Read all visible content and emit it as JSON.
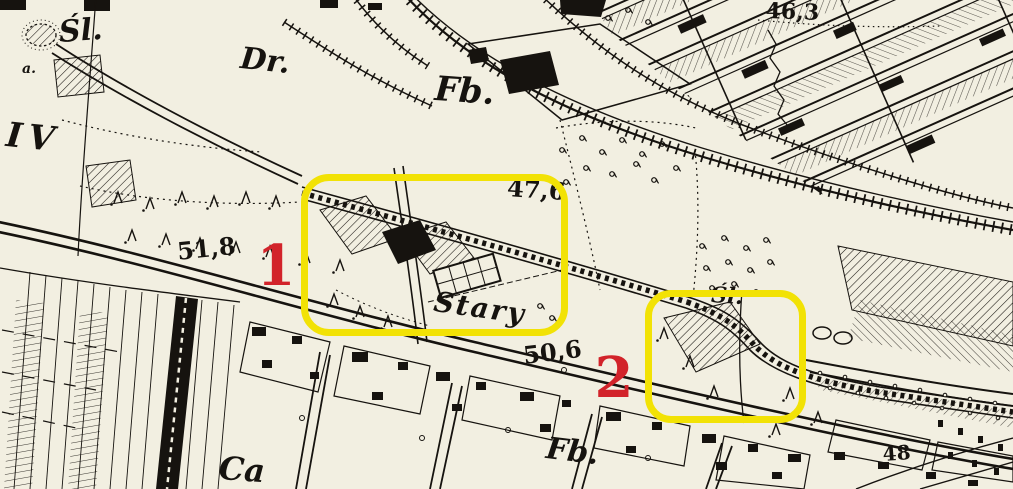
{
  "map": {
    "description": "Historical black-and-white topographic map scan with two yellow highlight boxes numbered in red",
    "colors": {
      "paper": "#f2efe1",
      "ink": "#16130f",
      "highlight": "#f2e205",
      "marker": "#d2232a"
    },
    "labels": [
      {
        "id": "settlement-sl-top",
        "text": "Śl."
      },
      {
        "id": "letter-a-west",
        "text": "a."
      },
      {
        "id": "settlement-dr",
        "text": "Dr."
      },
      {
        "id": "district-iv",
        "text": "IV"
      },
      {
        "id": "factory-fb-top",
        "text": "Fb."
      },
      {
        "id": "elevation-46-3",
        "text": "46,3"
      },
      {
        "id": "elevation-47-6",
        "text": "47,6"
      },
      {
        "id": "elevation-51-8",
        "text": "51,8"
      },
      {
        "id": "place-stary",
        "text": "Stary"
      },
      {
        "id": "settlement-sl-box2",
        "text": "Śl."
      },
      {
        "id": "elevation-50-6",
        "text": "50,6"
      },
      {
        "id": "factory-fb-bottom",
        "text": "Fb."
      },
      {
        "id": "elevation-48",
        "text": "48"
      },
      {
        "id": "place-ca",
        "text": "Ca"
      }
    ],
    "annotations": {
      "boxes": [
        {
          "id": "box-1",
          "marker": "1"
        },
        {
          "id": "box-2",
          "marker": "2"
        }
      ]
    }
  }
}
